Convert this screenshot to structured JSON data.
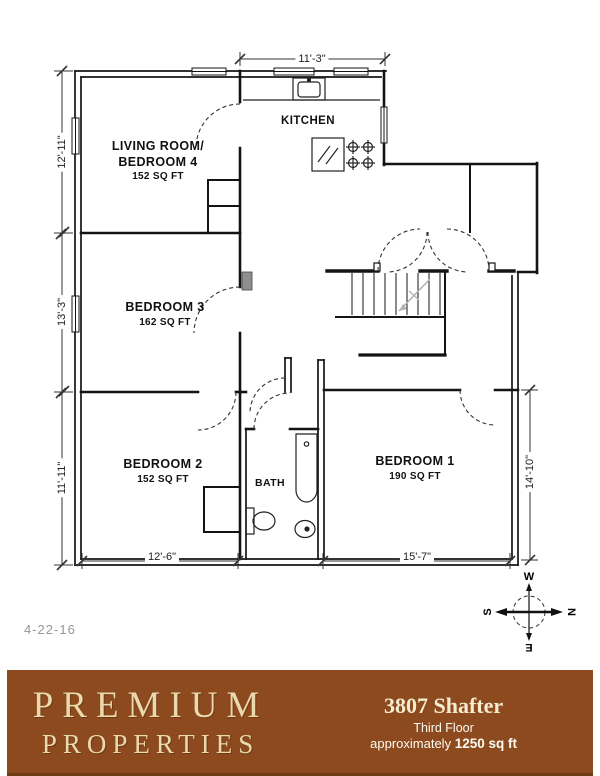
{
  "plan": {
    "date": "4-22-16",
    "rooms": {
      "living": {
        "line1": "LIVING ROOM/",
        "line2": "BEDROOM 4",
        "area": "152 SQ FT"
      },
      "kitchen": {
        "name": "KITCHEN"
      },
      "bed3": {
        "name": "BEDROOM 3",
        "area": "162 SQ FT"
      },
      "bed2": {
        "name": "BEDROOM 2",
        "area": "152 SQ FT"
      },
      "bath": {
        "name": "BATH"
      },
      "bed1": {
        "name": "BEDROOM 1",
        "area": "190 SQ FT"
      }
    },
    "dims": {
      "top": "11'-3\"",
      "left_top": "12'-11\"",
      "left_mid": "13'-3\"",
      "left_bot": "11'-11\"",
      "bottom_left": "12'-6\"",
      "bottom_right": "15'-7\"",
      "right": "14'-10\""
    },
    "compass": {
      "n": "N",
      "e": "E",
      "s": "S",
      "w": "W"
    }
  },
  "footer": {
    "bg_color": "#8C4A1E",
    "brand_color": "#E9D9AC",
    "brand_line1": "PREMIUM",
    "brand_line2": "PROPERTIES",
    "address": "3807 Shafter",
    "floor": "Third Floor",
    "approx_prefix": "approximately ",
    "approx_area": "1250 sq ft"
  }
}
